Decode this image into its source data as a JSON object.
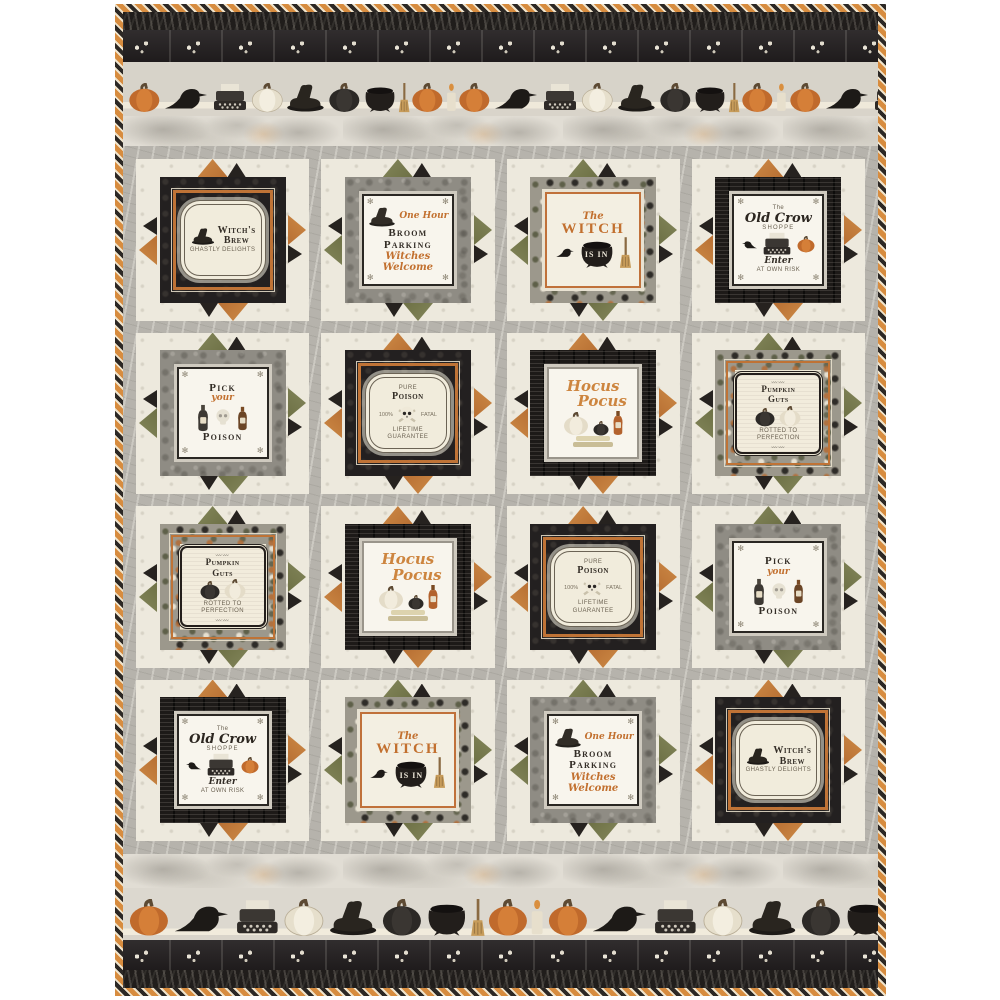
{
  "colors": {
    "binding_orange": "#d78c3f",
    "binding_cream": "#f0e4cc",
    "binding_black": "#2c2825",
    "points_orange": "#c5813f",
    "points_green": "#767a4c",
    "accent_orange": "#c2702f",
    "ink_dark": "#332d26",
    "black_fabric": "#232020",
    "gray_fabric": "#8f8c84",
    "cream_block": "#ede9dd",
    "sashing_gray": "#b6b3ac",
    "smoke": "#e1ddd4"
  },
  "borders": {
    "icon_sequence": [
      "pumpkin",
      "crow",
      "typewriter",
      "white-pumpkin",
      "witch-hat",
      "black-pumpkin",
      "cauldron",
      "broom",
      "pumpkin",
      "candle"
    ]
  },
  "blocks": [
    {
      "type": "witchs-brew",
      "points": "orange",
      "title1": "Witch's",
      "title2": "Brew",
      "sub": "GHASTLY DELIGHTS"
    },
    {
      "type": "broom-parking",
      "points": "green",
      "pre": "One Hour",
      "title": "Broom Parking",
      "script": "Witches Welcome"
    },
    {
      "type": "witch-is-in",
      "points": "green",
      "the": "The",
      "title": "WITCH",
      "cauldron": "IS IN"
    },
    {
      "type": "old-crow",
      "points": "orange",
      "the": "The",
      "title": "Old Crow",
      "shoppe": "SHOPPE",
      "enter": "Enter",
      "sub": "AT OWN RISK"
    },
    {
      "type": "pick-poison",
      "points": "green",
      "top": "Pick",
      "script": "your",
      "bottom": "Poison"
    },
    {
      "type": "poison",
      "points": "orange",
      "arch": "PURE",
      "title": "Poison",
      "left": "100%",
      "right": "FATAL",
      "bottom": "LIFETIME GUARANTEE"
    },
    {
      "type": "hocus-pocus",
      "points": "orange",
      "s1": "Hocus",
      "s2": "Pocus"
    },
    {
      "type": "pumpkin-guts",
      "points": "green",
      "t1": "Pumpkin",
      "t2": "Guts",
      "sub": "ROTTED TO PERFECTION"
    },
    {
      "type": "pumpkin-guts",
      "points": "green",
      "t1": "Pumpkin",
      "t2": "Guts",
      "sub": "ROTTED TO PERFECTION"
    },
    {
      "type": "hocus-pocus",
      "points": "orange",
      "s1": "Hocus",
      "s2": "Pocus"
    },
    {
      "type": "poison",
      "points": "orange",
      "arch": "PURE",
      "title": "Poison",
      "left": "100%",
      "right": "FATAL",
      "bottom": "LIFETIME GUARANTEE"
    },
    {
      "type": "pick-poison",
      "points": "green",
      "top": "Pick",
      "script": "your",
      "bottom": "Poison"
    },
    {
      "type": "old-crow",
      "points": "orange",
      "the": "The",
      "title": "Old Crow",
      "shoppe": "SHOPPE",
      "enter": "Enter",
      "sub": "AT OWN RISK"
    },
    {
      "type": "witch-is-in",
      "points": "green",
      "the": "The",
      "title": "WITCH",
      "cauldron": "IS IN"
    },
    {
      "type": "broom-parking",
      "points": "green",
      "pre": "One Hour",
      "title": "Broom Parking",
      "script": "Witches Welcome"
    },
    {
      "type": "witchs-brew",
      "points": "orange",
      "title1": "Witch's",
      "title2": "Brew",
      "sub": "GHASTLY DELIGHTS"
    }
  ]
}
